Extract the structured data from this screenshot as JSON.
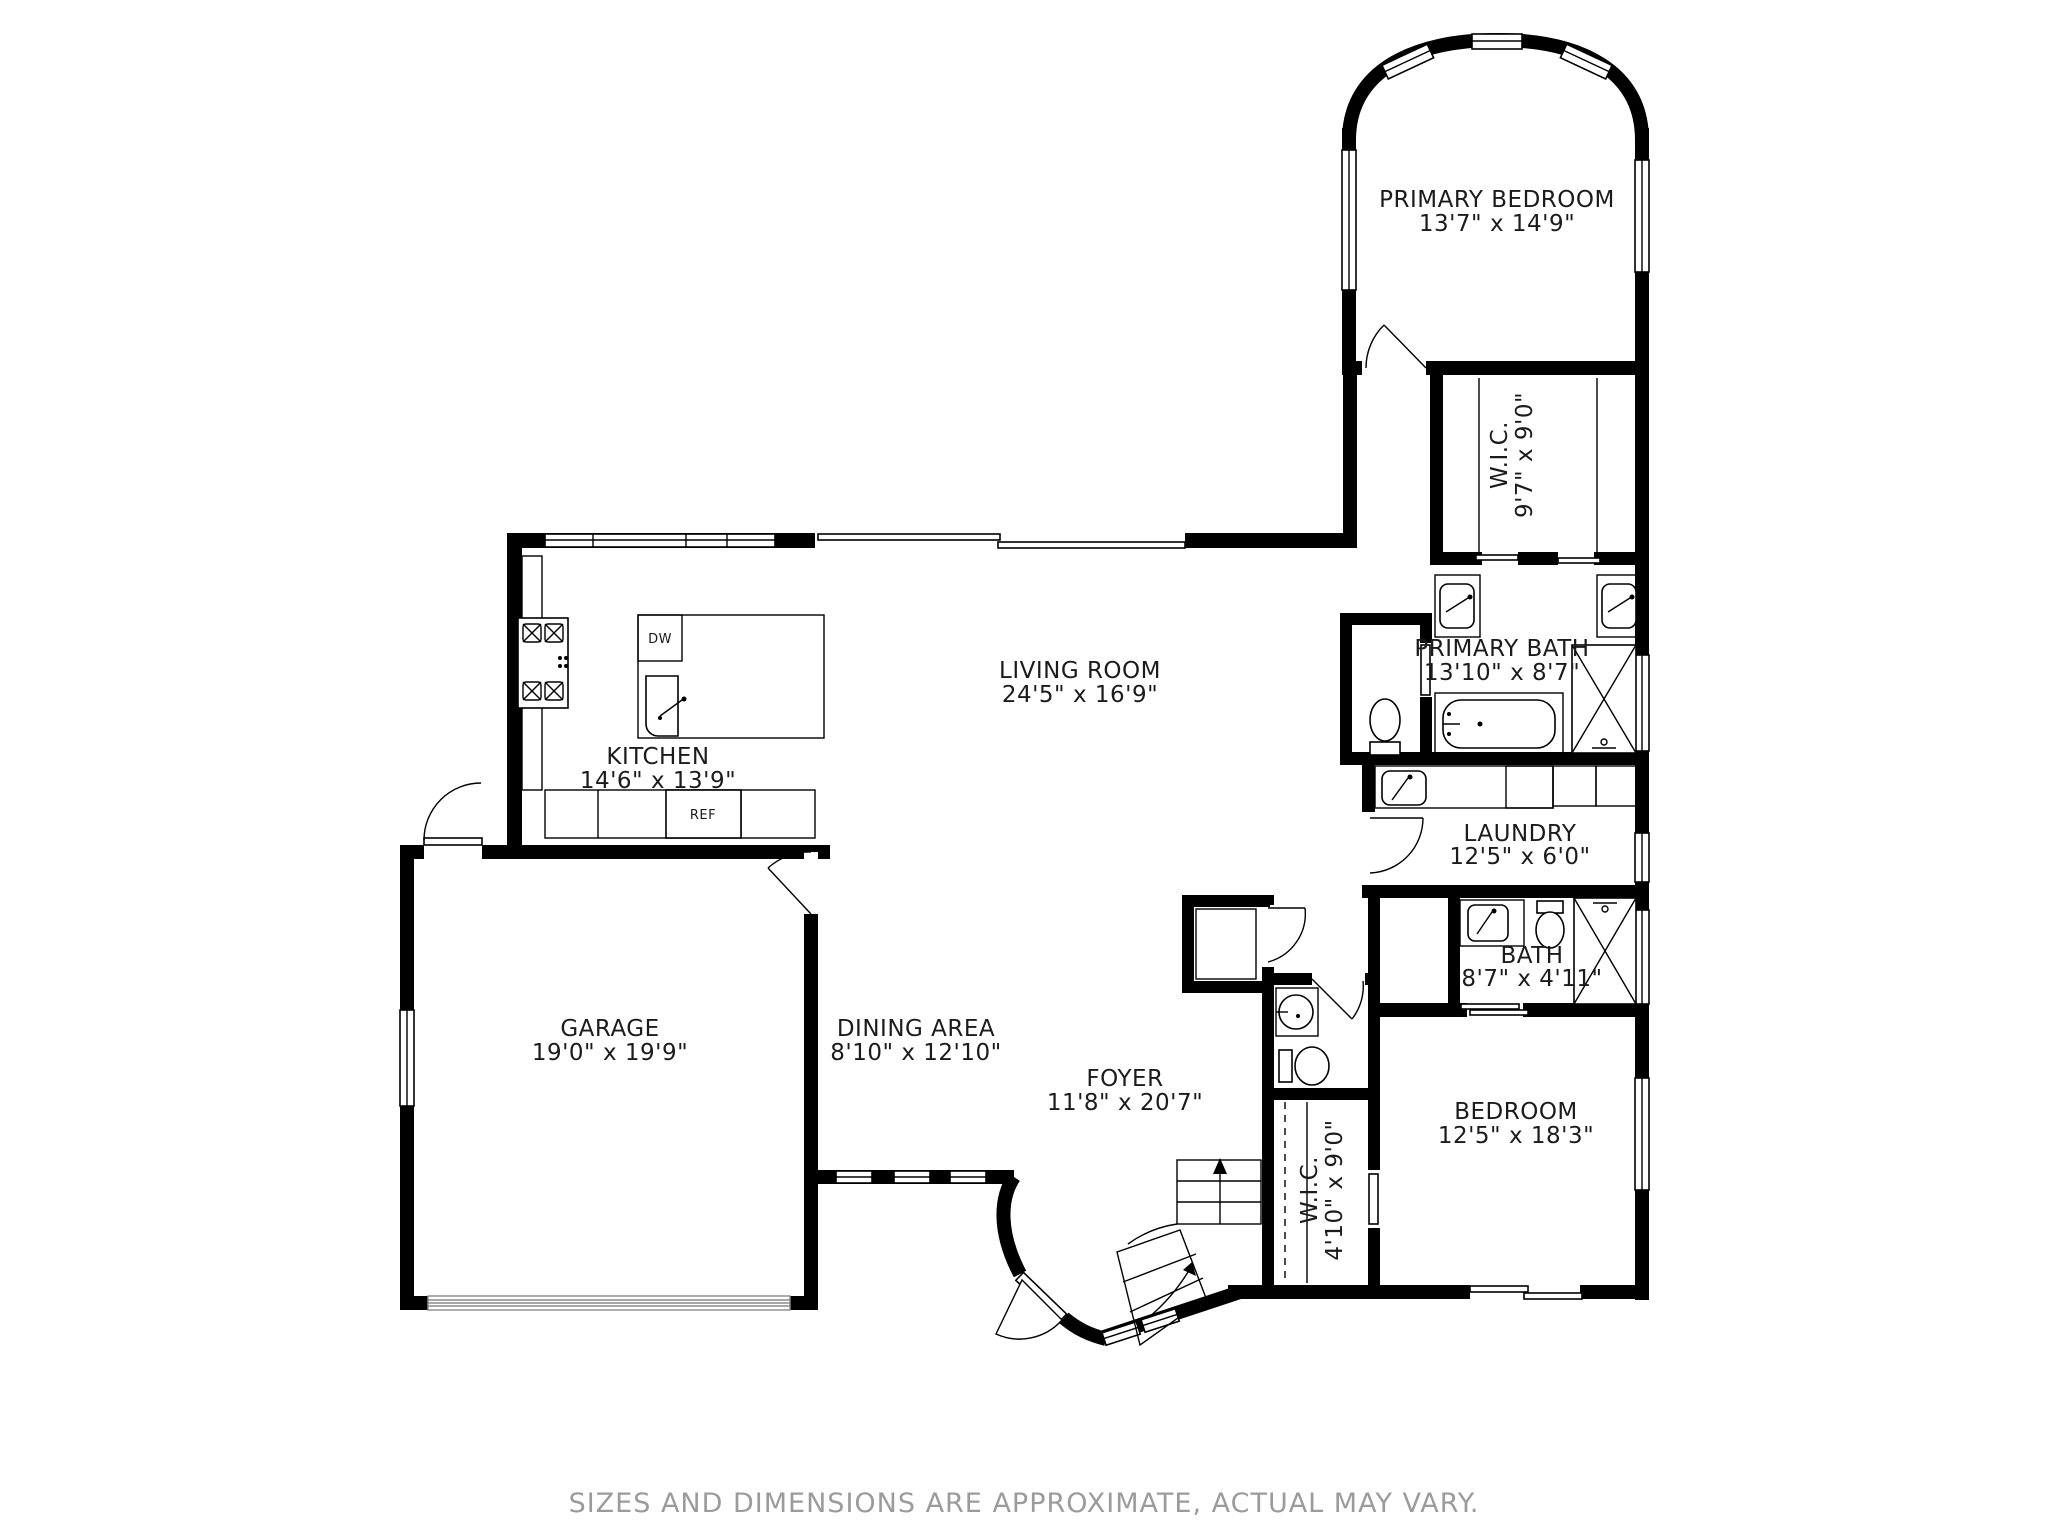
{
  "rooms": {
    "primary_bedroom": {
      "name": "PRIMARY BEDROOM",
      "dims": "13'7\" x 14'9\""
    },
    "wic_primary": {
      "name": "W.I.C.",
      "dims": "9'7\" x 9'0\""
    },
    "primary_bath": {
      "name": "PRIMARY BATH",
      "dims": "13'10\" x 8'7\""
    },
    "living_room": {
      "name": "LIVING ROOM",
      "dims": "24'5\" x 16'9\""
    },
    "kitchen": {
      "name": "KITCHEN",
      "dims": "14'6\" x 13'9\""
    },
    "laundry": {
      "name": "LAUNDRY",
      "dims": "12'5\" x 6'0\""
    },
    "bath": {
      "name": "BATH",
      "dims": "8'7\" x 4'11\""
    },
    "garage": {
      "name": "GARAGE",
      "dims": "19'0\" x 19'9\""
    },
    "dining_area": {
      "name": "DINING AREA",
      "dims": "8'10\" x 12'10\""
    },
    "foyer": {
      "name": "FOYER",
      "dims": "11'8\" x 20'7\""
    },
    "wic_bedroom": {
      "name": "W.I.C.",
      "dims": "4'10\" x 9'0\""
    },
    "bedroom": {
      "name": "BEDROOM",
      "dims": "12'5\" x 18'3\""
    }
  },
  "appliances": {
    "dishwasher": "DW",
    "refrigerator": "REF"
  },
  "footer": {
    "disclaimer": "SIZES AND DIMENSIONS ARE APPROXIMATE, ACTUAL MAY VARY."
  },
  "colors": {
    "wall": "#000000",
    "background": "#ffffff",
    "label": "#1b1b1b",
    "disclaimer": "#9b9b9b",
    "garage_door": "#8a8a8a"
  }
}
